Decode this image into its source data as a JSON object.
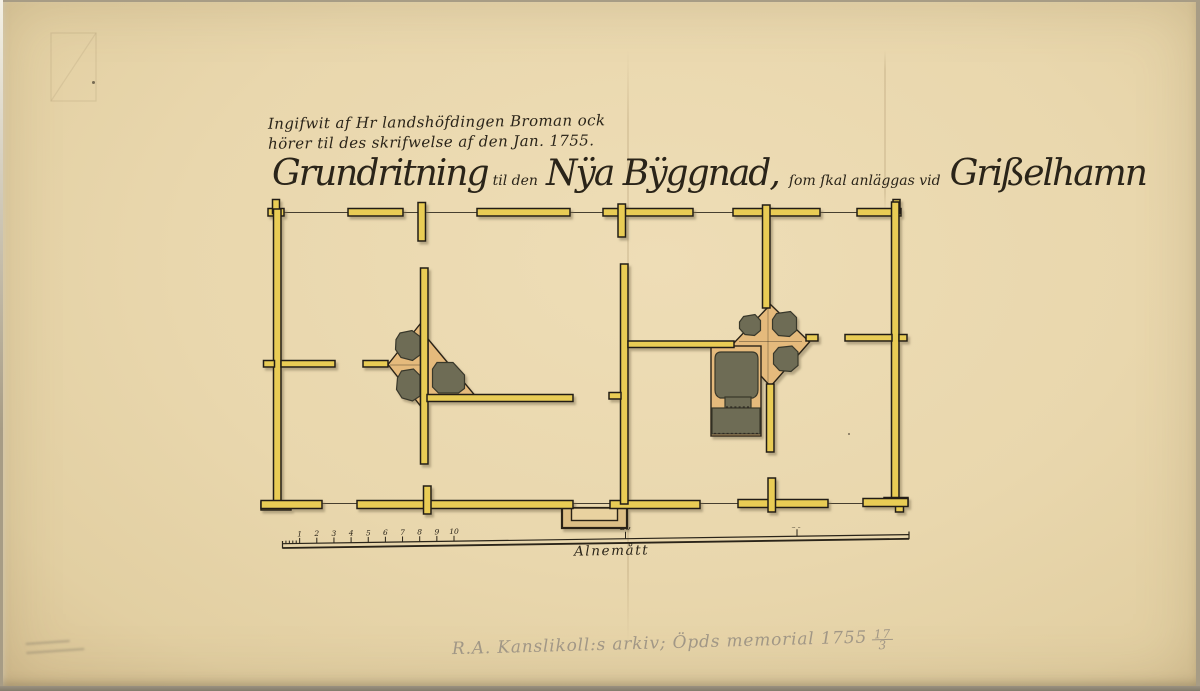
{
  "colors": {
    "ink": "#2a2419",
    "wall": "#e9cc55",
    "wall-stroke": "#211e15",
    "masonry": "#e5ba7c",
    "hearth": "#6e6c54",
    "hearth-stroke": "#39372c",
    "pencil": "#9a9183"
  },
  "document": {
    "submission_note": {
      "line1": "Ingifwit af Hr landshöfdingen Broman ock",
      "line2": "hörer til des skrifwelse af den  Jan. 1755."
    },
    "title": {
      "word1": "Grundritning",
      "word2": "til den",
      "word3": "Nÿa Bÿggnad,",
      "word4": "ſom ſkal anläggas vid",
      "word5": "Grißelhamn"
    },
    "scale_bar": {
      "label": "Alnemått",
      "unit_ticks": [
        1,
        2,
        3,
        4,
        5,
        6,
        7,
        8,
        9,
        10
      ],
      "major_ticks": [
        20,
        30
      ],
      "minor_tick_count": 4
    },
    "archive_note": {
      "text": "R.A. Kanslikoll:s arkiv; Öpds memorial 1755",
      "fraction_numerator": "17",
      "fraction_denominator": "3"
    }
  }
}
